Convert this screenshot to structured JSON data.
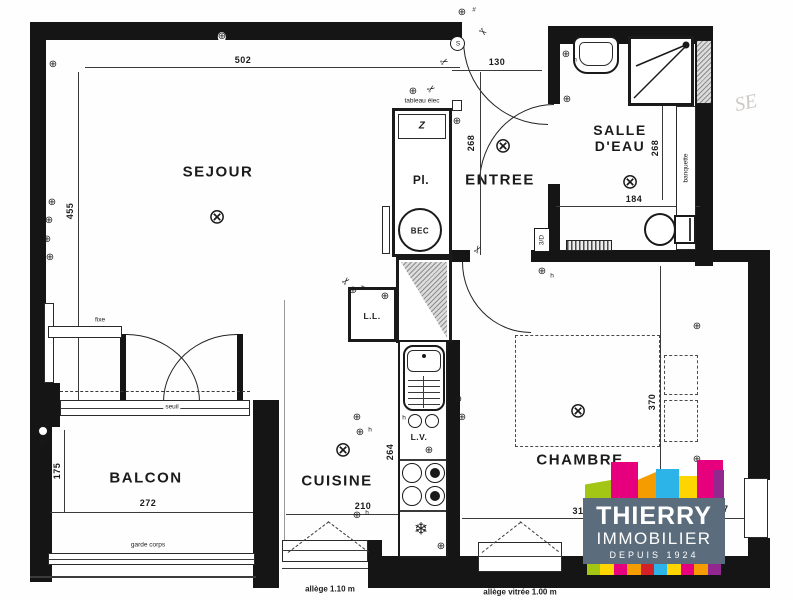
{
  "rooms": {
    "sejour": "SEJOUR",
    "entree": "ENTREE",
    "salle_deau": "SALLE D'EAU",
    "chambre": "CHAMBRE",
    "cuisine": "CUISINE",
    "balcon": "BALCON",
    "placard": "Pl.",
    "bec": "BEC",
    "lave_linge": "L.L.",
    "lave_vaisselle": "L.V."
  },
  "dimensions": {
    "sejour_width": "502",
    "sejour_height": "455",
    "entree_width": "130",
    "entree_height": "268",
    "salle_deau_height": "268",
    "salle_deau_width": "184",
    "chambre_height": "370",
    "chambre_width_left": "31",
    "chambre_width_right": "57",
    "balcon_width": "272",
    "balcon_height": "175",
    "cuisine_width": "210",
    "cuisine_height": "264"
  },
  "annotations": {
    "seuil": "seuil",
    "fixe": "fixe",
    "garde_corps": "garde corps",
    "allege_cuisine": "allège 1.10 m",
    "allege_chambre": "allège vitrée 1.00 m",
    "tableau_elec": "tableau élec",
    "banquette": "banquette",
    "ep": "EP",
    "sd_tag": "3/D",
    "h_mark": "h",
    "hash_mark": "#",
    "switch_s": "S",
    "watermark": "SE"
  },
  "symbols": {
    "ceiling_light": "⊗",
    "outlet": "⊕",
    "cut": "✂",
    "fridge": "❄",
    "shelf": "Z"
  },
  "logo": {
    "line1": "THIERRY",
    "line2": "IMMOBILIER",
    "line3": "DEPUIS 1924",
    "bg": "#5b6d7c",
    "palette": [
      "#a3c614",
      "#e6007e",
      "#f59c00",
      "#2cb4e8",
      "#ffd500",
      "#92278f",
      "#d42027"
    ]
  }
}
